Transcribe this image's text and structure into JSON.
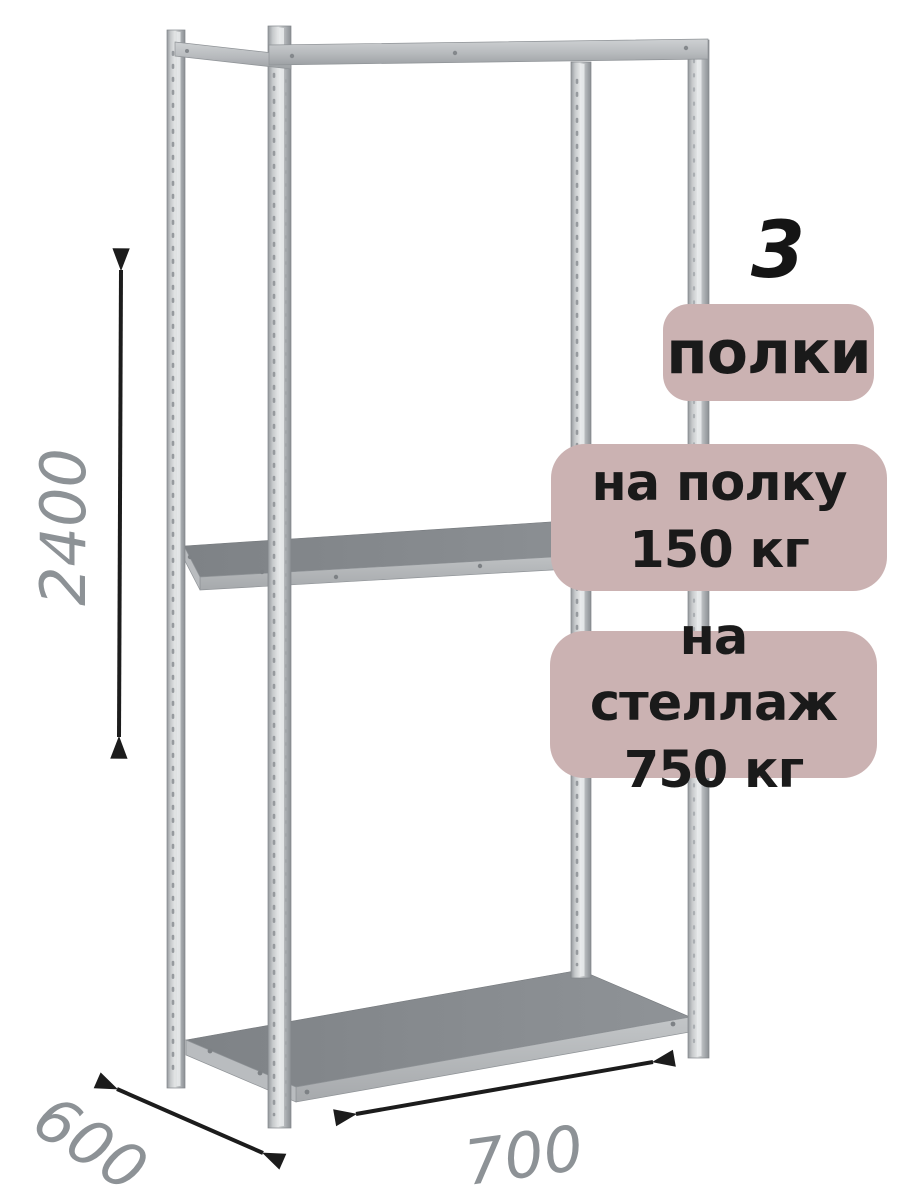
{
  "image": {
    "description": "Металлический стеллаж с полками — схема с габаритными размерами",
    "background": "#ffffff"
  },
  "colors": {
    "badge_background": "#cbb2b2",
    "badge_text": "#1a1a1a",
    "dimension_text": "#8d9296",
    "arrow": "#1c1c1c",
    "metal_light": "#e9ebec",
    "metal_mid": "#b6b9bc",
    "shelf_top": "#85898d"
  },
  "callouts": {
    "shelf_count_number": "3",
    "shelf_count_label": "полки",
    "per_shelf": {
      "line1": "на полку",
      "line2": "150 кг"
    },
    "per_rack": {
      "line1": "на стеллаж",
      "line2": "750 кг"
    }
  },
  "dimensions": {
    "height": "2400",
    "depth": "600",
    "width": "700"
  }
}
